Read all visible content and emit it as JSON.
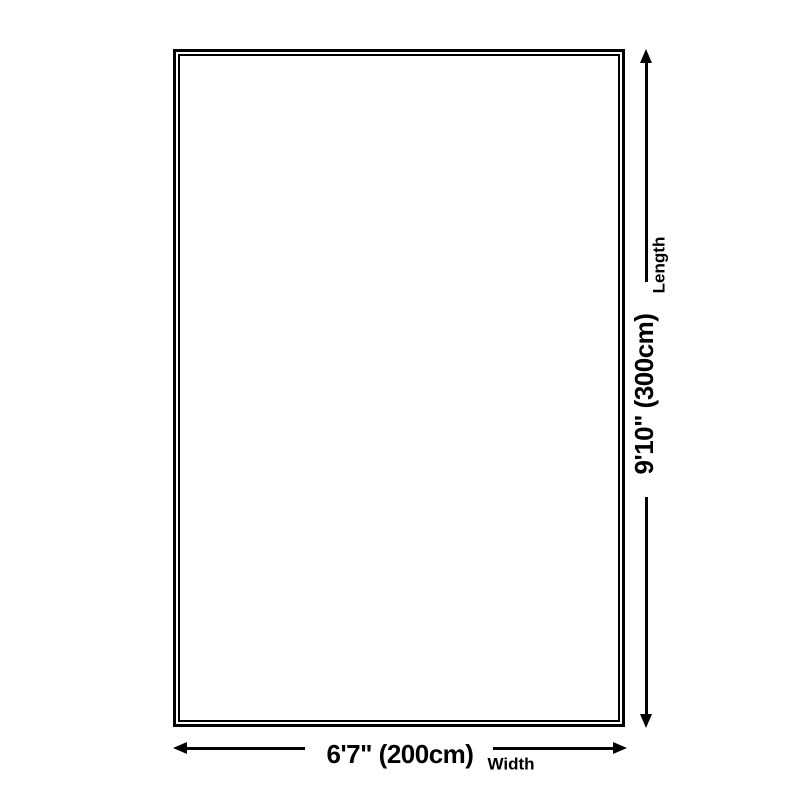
{
  "colors": {
    "line": "#000000",
    "background": "#ffffff"
  },
  "dimensions": {
    "width": {
      "value": "6'7\" (200cm)",
      "label": "Width"
    },
    "length": {
      "value": "9'10\" (300cm)",
      "label": "Length"
    }
  }
}
